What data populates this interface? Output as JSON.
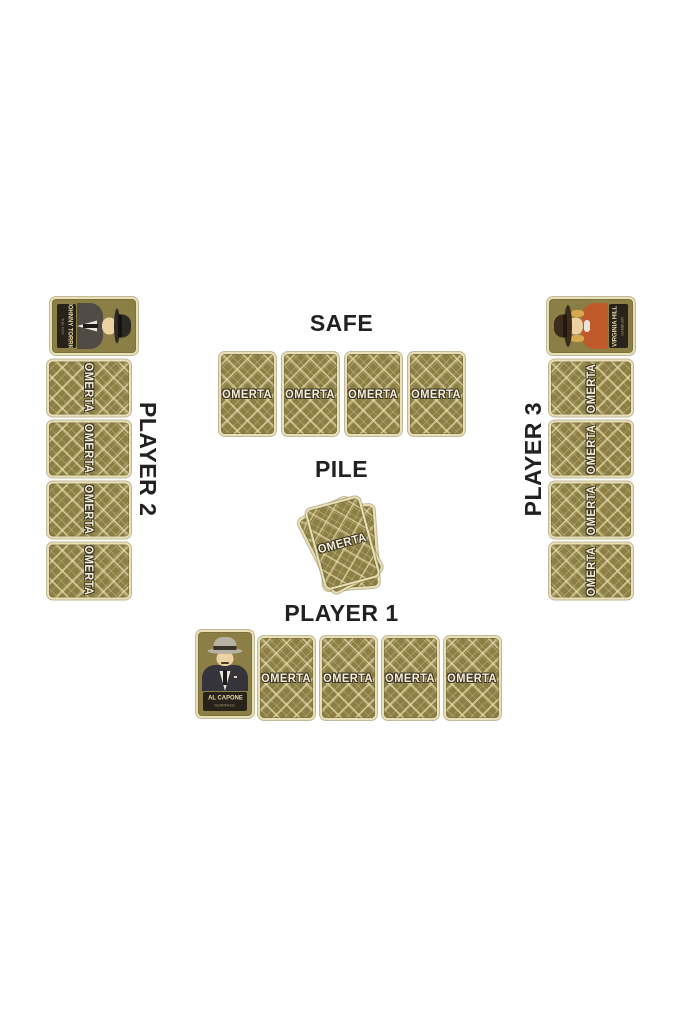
{
  "card_back": {
    "text": "OMERTA",
    "base_color": "#8c7f45",
    "pattern_color": "#cfc48e",
    "border_color": "#eae0b8",
    "text_color": "#f6efd7",
    "outline_color": "#3b3426"
  },
  "label_color": "#232020",
  "zones": {
    "safe": {
      "label": "SAFE",
      "cards": 4
    },
    "pile": {
      "label": "PILE",
      "visible_cards": 3
    },
    "player1": {
      "label": "PLAYER 1",
      "hand_cards": 4,
      "character": {
        "name": "AL CAPONE",
        "subtitle": "SCARFACE"
      }
    },
    "player2": {
      "label": "PLAYER 2",
      "hand_cards": 4,
      "character": {
        "name": "JOHNNY TORRIO",
        "subtitle": "THE FOX"
      }
    },
    "player3": {
      "label": "PLAYER 3",
      "hand_cards": 4,
      "character": {
        "name": "VIRGINIA HILL",
        "subtitle": "GAMBLER"
      }
    }
  }
}
